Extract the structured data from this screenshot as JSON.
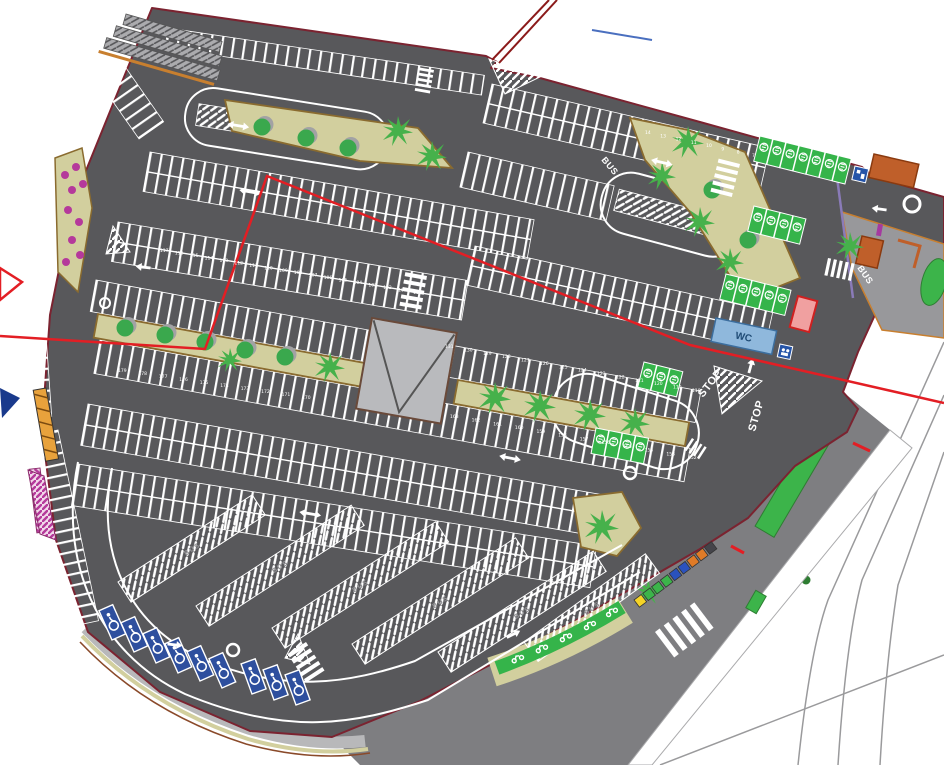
{
  "road_markings": {
    "stop": "STOP",
    "bus": "BUS"
  },
  "facilities": {
    "wc": "WC"
  },
  "bus_bays": {
    "labels": [
      "BUS",
      "BUS",
      "BUS",
      "BUS",
      "BUS",
      "BUS"
    ]
  },
  "stall_ranges": [
    {
      "id": "r100",
      "from": 117,
      "to": 100
    },
    {
      "id": "r118",
      "from": 131,
      "to": 118
    },
    {
      "id": "r152",
      "from": 163,
      "to": 152
    },
    {
      "id": "r170",
      "from": 179,
      "to": 170
    },
    {
      "id": "r7",
      "from": 14,
      "to": 7
    }
  ],
  "colors": {
    "asphalt": "#58585b",
    "stripe": "#ffffff",
    "island": "#d2cf9e",
    "island_border": "#8a6b2f",
    "curb_orange": "#c87f2f",
    "tree_green": "#3aa84d",
    "palm_green": "#46b14b",
    "property_line_red": "#e31e24",
    "boundary_maroon": "#7b2330",
    "disabled_stall_blue": "#2e4f9e",
    "ev_stall_green": "#35b44a",
    "flower_magenta": "#b5399b",
    "building_orange": "#bf5f2a",
    "kiosk_red": "#cc2222",
    "wc_blue": "#8fb8dc",
    "outer_road_gray": "#7e7e81"
  }
}
